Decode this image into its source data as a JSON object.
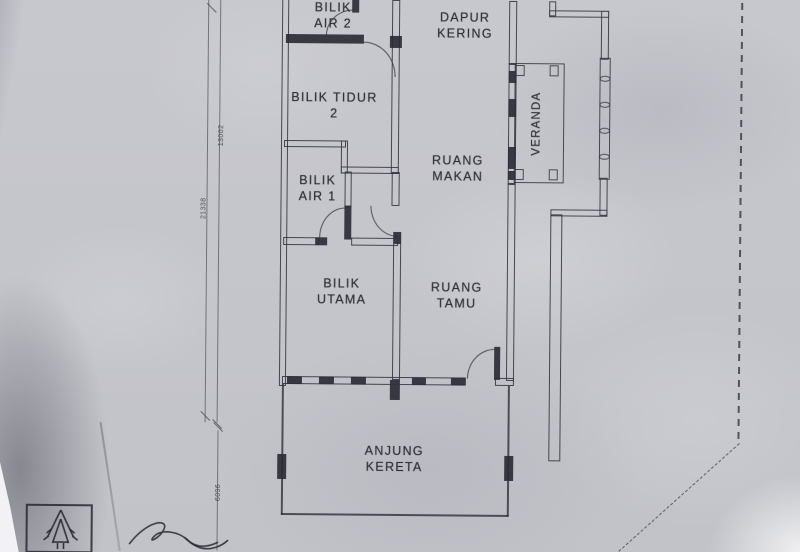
{
  "photo": {
    "description": "Photograph of a hand-drafted house floor plan on grey paper",
    "paper_color": "#c5c6cc",
    "ink_color": "#32333c"
  },
  "rooms": {
    "bilik_air_2": {
      "line1": "BILIK",
      "line2": "AIR 2"
    },
    "dapur_kering": {
      "line1": "DAPUR",
      "line2": "KERING"
    },
    "bilik_tidur_2": {
      "line1": "BILIK TIDUR",
      "line2": "2"
    },
    "ruang_makan": {
      "line1": "RUANG",
      "line2": "MAKAN"
    },
    "veranda": {
      "label": "VERANDA"
    },
    "bilik_air_1": {
      "line1": "BILIK",
      "line2": "AIR 1"
    },
    "bilik_utama": {
      "line1": "BILIK",
      "line2": "UTAMA"
    },
    "ruang_tamu": {
      "line1": "RUANG",
      "line2": "TAMU"
    },
    "anjung_kereta": {
      "line1": "ANJUNG",
      "line2": "KERETA"
    }
  },
  "dimensions": {
    "left_upper": "13002",
    "left_overall": "21338",
    "left_lower": "6096"
  },
  "symbols": {
    "tree_symbol": "tree-in-box",
    "signature": "handwritten-initials",
    "boundary": "dashed lot boundary line"
  }
}
